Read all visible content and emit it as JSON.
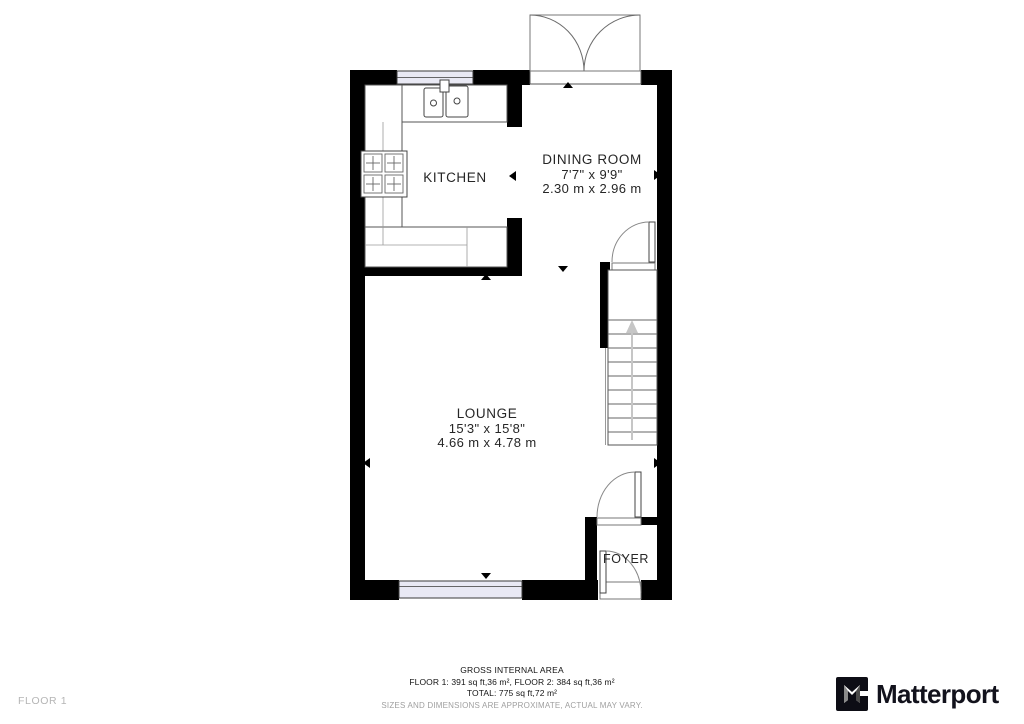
{
  "plan": {
    "rooms": {
      "kitchen": {
        "name": "KITCHEN"
      },
      "dining": {
        "name": "DINING ROOM",
        "imperial": "7'7\" x 9'9\"",
        "metric": "2.30 m x 2.96 m"
      },
      "lounge": {
        "name": "LOUNGE",
        "imperial": "15'3\" x 15'8\"",
        "metric": "4.66 m x 4.78 m"
      },
      "foyer": {
        "name": "FOYER"
      }
    }
  },
  "footer": {
    "gross_title": "GROSS INTERNAL AREA",
    "floors_line": "FLOOR 1: 391 sq ft,36 m², FLOOR 2: 384 sq ft,36 m²",
    "total_line": "TOTAL: 775 sq ft,72 m²",
    "disclaimer": "SIZES AND DIMENSIONS ARE APPROXIMATE, ACTUAL MAY VARY.",
    "floor_label": "FLOOR 1"
  },
  "branding": {
    "logo_text": "Matterport"
  },
  "colors": {
    "wall": "#000000",
    "window_fill": "#e9e9f4",
    "line": "#555555",
    "stair_arrow": "#c6c6c6",
    "logo_text": "#12121c"
  }
}
